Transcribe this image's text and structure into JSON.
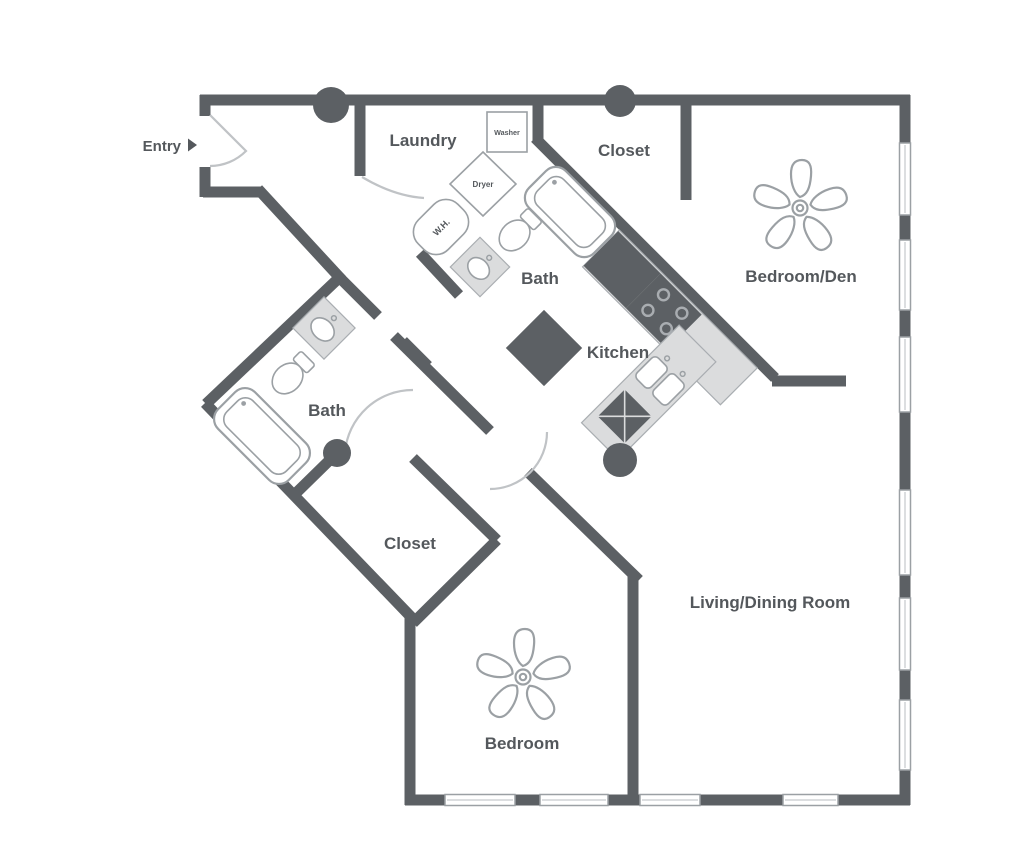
{
  "floorplan": {
    "type": "apartment-floor-plan",
    "colors": {
      "background": "#ffffff",
      "wall": "#5c6064",
      "fixture_outline": "#9ba0a4",
      "counter_fill": "#dbdcdd",
      "label_text": "#54585c",
      "door_arc": "#c0c3c6"
    },
    "entry": {
      "label": "Entry"
    },
    "rooms": {
      "laundry": "Laundry",
      "closet_top": "Closet",
      "bedroom_den": "Bedroom/Den",
      "bath_top": "Bath",
      "kitchen": "Kitchen",
      "bath_left": "Bath",
      "closet_mid": "Closet",
      "living_dining": "Living/Dining Room",
      "bedroom": "Bedroom"
    },
    "appliances": {
      "washer": "Washer",
      "dryer": "Dryer",
      "water_heater": "W.H."
    },
    "features": {
      "ceiling_fans": 2,
      "columns": 4,
      "bathtubs": 2,
      "toilets": 2,
      "bath_sinks": 2,
      "kitchen_sink_basins": 2,
      "windows_right_wall": 6,
      "windows_bottom_wall": 4
    }
  }
}
